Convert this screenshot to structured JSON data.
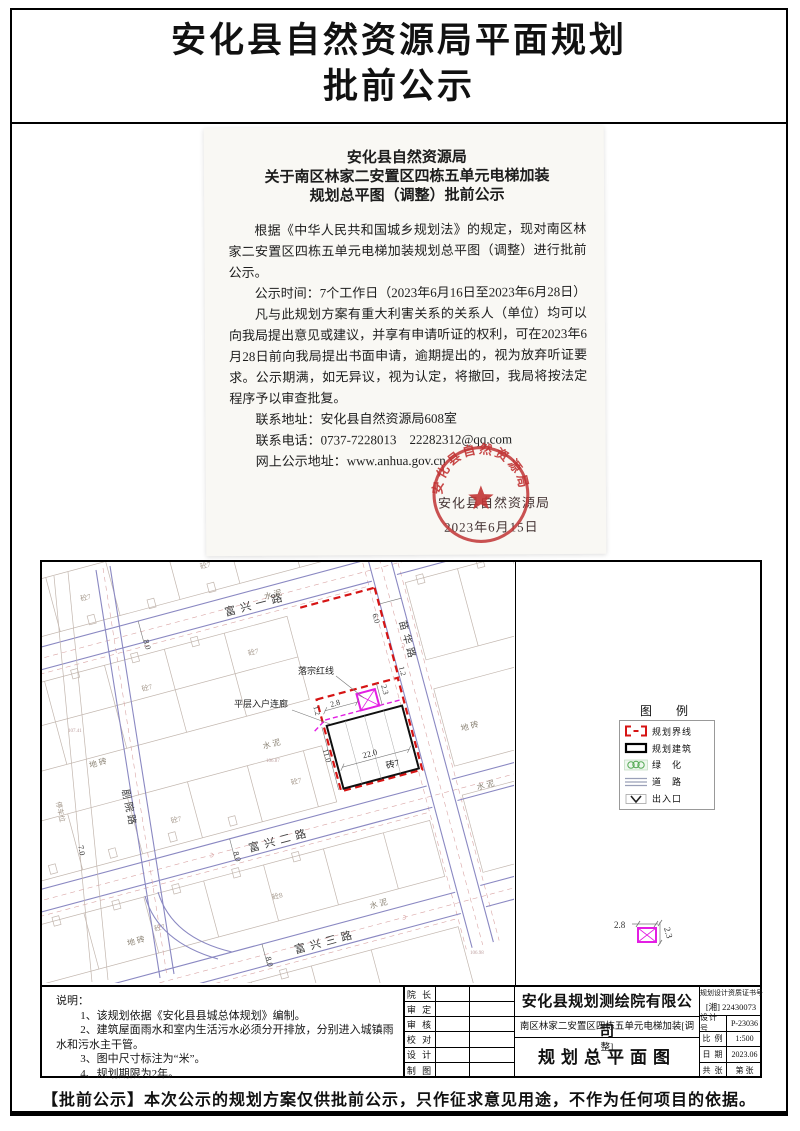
{
  "header": {
    "title_line1": "安化县自然资源局平面规划",
    "title_line2": "批前公示"
  },
  "notice": {
    "heading1": "安化县自然资源局",
    "heading2": "关于南区林家二安置区四栋五单元电梯加装",
    "heading3": "规划总平图（调整）批前公示",
    "para1": "根据《中华人民共和国城乡规划法》的规定，现对南区林家二安置区四栋五单元电梯加装规划总平图（调整）进行批前公示。",
    "para2": "公示时间：7个工作日（2023年6月16日至2023年6月28日）",
    "para3": "凡与此规划方案有重大利害关系的关系人（单位）均可以向我局提出意见或建议，并享有申请听证的权利，可在2023年6月28日前向我局提出书面申请，逾期提出的，视为放弃听证要求。公示期满，如无异议，视为认定，将撤回，我局将按法定程序予以审查批复。",
    "contact_address": "联系地址：安化县自然资源局608室",
    "contact_phone": "联系电话：0737-7228013　22282312@qq.com",
    "online_address": "网上公示地址：www.anhua.gov.cn",
    "seal_text": "安化县自然资源局",
    "signature": "安化县自然资源局",
    "sign_date": "2023年6月15日"
  },
  "map": {
    "roads": {
      "r1": "富兴一路",
      "r2": "富兴二路",
      "r3": "富兴三路",
      "left": "剧院路",
      "right": "苗华路"
    },
    "dims": {
      "w8": "8.0",
      "w7": "7.0",
      "w6": "6.0",
      "len": "22.0",
      "dep": "11.0",
      "cw": "2.8",
      "cd": "2.3",
      "gap": "1.2"
    },
    "labels": {
      "cement": "水泥",
      "tile": "地砖",
      "parking": "停车位",
      "brick7": "砖7",
      "conc7": "砼7",
      "conc8": "砼8",
      "redline": "落宗红线",
      "corridor": "平层入户连廊"
    },
    "elevations": {
      "e1": "107.41",
      "e2": "106.87",
      "e3": "106.98"
    }
  },
  "legend": {
    "title": "图　例",
    "items": [
      "规划界线",
      "规划建筑",
      "绿　化",
      "道　路",
      "出入口"
    ]
  },
  "notes": {
    "title": "说明：",
    "item1": "1、该规划依据《安化县县城总体规划》编制。",
    "item2": "2、建筑屋面雨水和室内生活污水必须分开排放，分别进入城镇雨水和污水主干管。",
    "item3": "3、图中尺寸标注为“米”。",
    "item4": "4、规划期限为2年。"
  },
  "titleblock": {
    "roles": [
      "院 长",
      "审 定",
      "审 核",
      "校 对",
      "设 计",
      "制 图"
    ],
    "company": "安化县规划测绘院有限公司",
    "project": "南区林家二安置区四栋五单元电梯加装[调整]",
    "drawing_title": "规划总平面图",
    "cert_label": "规划设计资质证书号",
    "cert_no": "[湘] 22430073",
    "f1_label": "设计号",
    "f1_value": "P-23036",
    "f2_label": "比 例",
    "f2_value": "1:500",
    "f3_label": "日 期",
    "f3_value": "2023.06",
    "f4_label": "共 张",
    "f4_value": "第 张"
  },
  "footer": {
    "text": "【批前公示】本次公示的规划方案仅供批前公示，只作征求意见用途，不作为任何项目的依据。"
  }
}
